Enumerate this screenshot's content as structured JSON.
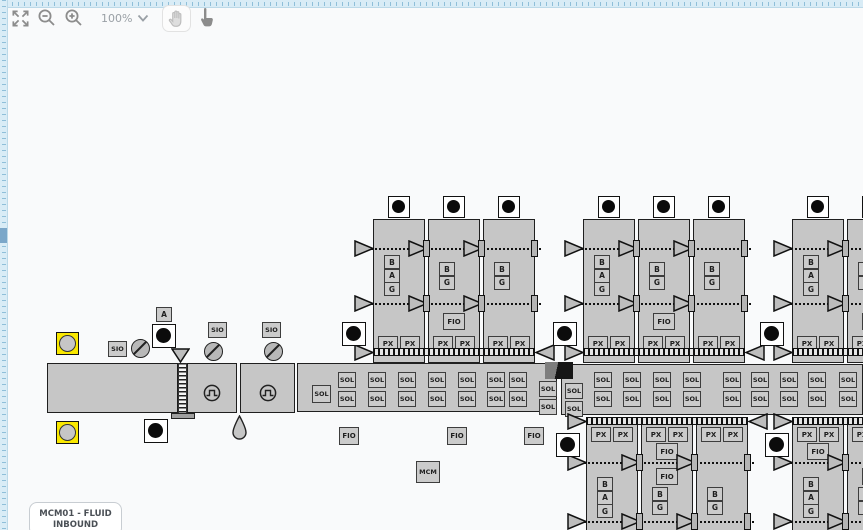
{
  "toolbar": {
    "zoom_level": "100%"
  },
  "labels": {
    "sol": "SOL",
    "px": "PX",
    "fio": "FIO",
    "sio": "SIO",
    "a": "A",
    "b": "B",
    "g": "G",
    "mcm": "MCM"
  },
  "title_card": {
    "line1": "MCM01 - FLUID",
    "line2": "INBOUND"
  },
  "colors": {
    "canvas": "#f9fafb",
    "ruler_bg": "#d9ecf6",
    "ruler_tick": "#8fbfd9",
    "shape_fill": "#c6c6c6",
    "shape_border": "#1f1f1f",
    "box_fill": "#cbcbcb",
    "highlight_yellow": "#fae800",
    "lamp_black": "#0c0c0c"
  },
  "diagram": {
    "pipe": {
      "rects": [
        {
          "x": 47,
          "y": 363,
          "w": 131,
          "h": 50,
          "pulse": false
        },
        {
          "x": 187,
          "y": 363,
          "w": 50,
          "h": 50,
          "pulse": true
        },
        {
          "x": 240,
          "y": 363,
          "w": 55,
          "h": 50,
          "pulse": true
        }
      ],
      "zipper": {
        "x": 178,
        "y": 363,
        "w": 9,
        "h": 51
      },
      "bar": {
        "x": 171,
        "y": 413,
        "w": 24,
        "h": 6
      },
      "tri_down": {
        "x": 171,
        "y": 348
      },
      "droplet": {
        "x": 231,
        "y": 415
      }
    },
    "manifolds": [
      {
        "x": 297,
        "y": 363,
        "w": 260,
        "h": 49,
        "single_sol": {
          "x": 312,
          "y": 385
        },
        "cols": [
          338,
          368,
          398,
          428,
          458,
          487,
          509
        ],
        "top_y": 372,
        "bot_y": 391,
        "end_cols": [
          {
            "x": 539,
            "top": 381,
            "bot": 399
          }
        ]
      },
      {
        "x": 561,
        "y": 364,
        "w": 302,
        "h": 51,
        "cols": [
          594,
          623,
          653,
          683,
          723,
          751,
          780,
          808,
          839
        ],
        "top_y": 372,
        "bot_y": 391,
        "end_cols": [
          {
            "x": 565,
            "top": 383,
            "bot": 401
          }
        ]
      }
    ],
    "folded_corner": {
      "x": 545,
      "y": 362,
      "w": 28,
      "h": 17
    },
    "groups": [
      {
        "id": "top-1",
        "side": "top",
        "x": 373,
        "lamp_x": 342,
        "units": [
          {
            "labels": [
              "B",
              "A",
              "G"
            ]
          },
          {
            "labels": [
              "B",
              "G"
            ],
            "fio": true
          },
          {
            "labels": [
              "B",
              "G"
            ]
          }
        ]
      },
      {
        "id": "top-2",
        "side": "top",
        "x": 583,
        "lamp_x": 553,
        "units": [
          {
            "labels": [
              "B",
              "A",
              "G"
            ]
          },
          {
            "labels": [
              "B",
              "G"
            ],
            "fio": true
          },
          {
            "labels": [
              "B",
              "G"
            ]
          }
        ]
      },
      {
        "id": "top-3",
        "side": "top",
        "x": 792,
        "lamp_x": 760,
        "units": [
          {
            "labels": [
              "B",
              "A",
              "G"
            ]
          },
          {
            "labels": [
              "B",
              "G"
            ],
            "fio": true
          }
        ]
      },
      {
        "id": "bottom-1",
        "side": "bottom",
        "x": 586,
        "lamp_x": 556,
        "units": [
          {
            "labels": [
              "B",
              "A",
              "G"
            ]
          },
          {
            "labels": [
              "B",
              "G"
            ],
            "fio_top": true,
            "fio": true
          },
          {
            "labels": [
              "B",
              "G"
            ]
          }
        ]
      },
      {
        "id": "bottom-2",
        "side": "bottom",
        "x": 792,
        "lamp_x": 765,
        "units": [
          {
            "labels": [
              "B",
              "A",
              "G"
            ],
            "fio_top": true
          },
          {
            "labels": [
              "B",
              "G"
            ],
            "fio": true
          }
        ]
      }
    ],
    "symbols": [
      {
        "type": "yellow_port",
        "x": 56,
        "y": 332
      },
      {
        "type": "yellow_port",
        "x": 56,
        "y": 421
      },
      {
        "type": "lamp",
        "x": 152,
        "y": 324
      },
      {
        "type": "lamp",
        "x": 144,
        "y": 419
      },
      {
        "type": "sio",
        "x": 108,
        "y": 341
      },
      {
        "type": "sio",
        "x": 208,
        "y": 322
      },
      {
        "type": "sio",
        "x": 262,
        "y": 322
      },
      {
        "type": "slash_valve",
        "x": 131,
        "y": 339
      },
      {
        "type": "slash_valve",
        "x": 204,
        "y": 342
      },
      {
        "type": "slash_valve",
        "x": 264,
        "y": 342
      },
      {
        "type": "a_box",
        "x": 156,
        "y": 307
      },
      {
        "type": "fio",
        "x": 339,
        "y": 427
      },
      {
        "type": "fio",
        "x": 447,
        "y": 427
      },
      {
        "type": "fio",
        "x": 524,
        "y": 427
      },
      {
        "type": "mcm",
        "x": 416,
        "y": 461
      }
    ]
  }
}
